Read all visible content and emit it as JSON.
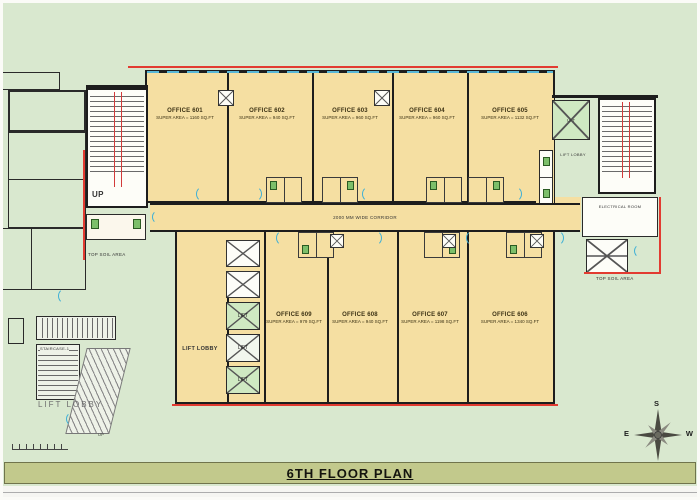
{
  "title": "6TH FLOOR PLAN",
  "colors": {
    "background": "#d9e8cf",
    "office_fill": "#f5dfa2",
    "lift_fill": "#cfe9c2",
    "title_bar": "#c2c98c",
    "boundary_red": "#e23b31",
    "door_cyan": "#3fb0d6",
    "wall": "#1d1d1d"
  },
  "offices": {
    "top_row": [
      {
        "name": "OFFICE 601",
        "area": "SUPER AREA = 1160 SQ.FT"
      },
      {
        "name": "OFFICE 602",
        "area": "SUPER AREA = 940 SQ.FT"
      },
      {
        "name": "OFFICE 603",
        "area": "SUPER AREA = 960 SQ.FT"
      },
      {
        "name": "OFFICE 604",
        "area": "SUPER AREA = 960 SQ.FT"
      },
      {
        "name": "OFFICE 605",
        "area": "SUPER AREA = 1132 SQ.FT"
      }
    ],
    "bottom_row": [
      {
        "name": "OFFICE 609",
        "area": "SUPER AREA = 979 SQ.FT"
      },
      {
        "name": "OFFICE 608",
        "area": "SUPER AREA = 940 SQ.FT"
      },
      {
        "name": "OFFICE 607",
        "area": "SUPER AREA = 1198 SQ.FT"
      },
      {
        "name": "OFFICE 606",
        "area": "SUPER AREA = 1340 SQ.FT"
      }
    ]
  },
  "labels": {
    "corridor": "2000 MM WIDE CORRIDOR",
    "lift_lobby": "LIFT LOBBY",
    "lift": "LIFT",
    "up": "UP",
    "top_soil": "TOP SOIL AREA",
    "electrical_room": "ELECTRICAL ROOM",
    "lift_lobby_small": "LIFT LOBBY",
    "staircase_detail": "STAIRCASE-1",
    "detail_lift_lobby": "LIFT LOBBY",
    "detail_up": "UP"
  },
  "compass": {
    "top": "S",
    "right": "W",
    "bottom": "N",
    "left": "E"
  }
}
